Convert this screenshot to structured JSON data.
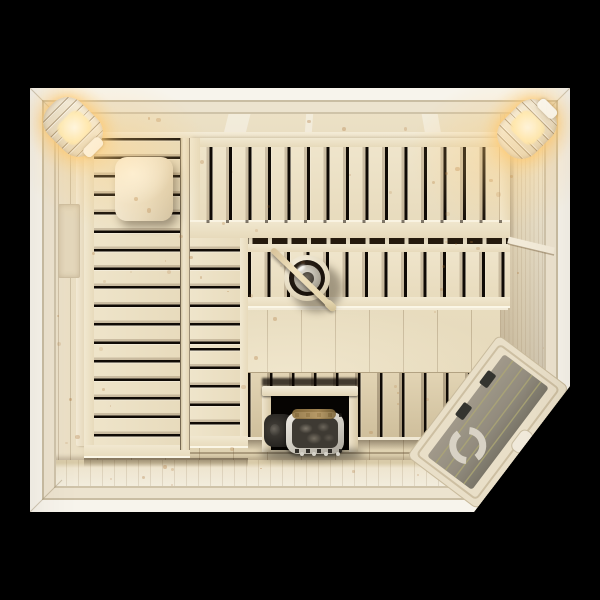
{
  "scene": {
    "description": "Top-down 3D render of a wooden sauna interior on a black background",
    "view": "top-down",
    "contains_text": false,
    "visible_text": ""
  },
  "objects": {
    "upper_bench": "upper tier bench with vertical slats along the top wall",
    "middle_bench": "lower tier bench with vertical slats",
    "left_bench": "full-length lounging bench with horizontal slats along the left wall",
    "bench_step": "lower step extension of the left bench",
    "headrest": "curved wooden headrest on the left bench",
    "bucket": "sauna bucket with ladle resting across it",
    "heater": "electric sauna heater filled with stones inside a wooden safety guard",
    "glass_door": "tinted glass door in the chamfered bottom-right corner with round logo, two hinges and handle",
    "lamp_left": "glowing wooden corner lamp, top-left",
    "lamp_right": "glowing wooden corner lamp, top-right",
    "backrest_rails": "backrest rails mounted on the walls",
    "floor": "wooden floor boards"
  },
  "colors": {
    "bg": "#000000",
    "trim-light": "#f8f5ee",
    "trim-cream": "#ece3cf",
    "groove": "#cbbfa6",
    "wood-mid": "#e9ddc1",
    "slot": "#0f0a05",
    "glass": "#867f6f",
    "glass-gap": "#a7a169",
    "logo": "#d8d2c5",
    "glow": "#ffd993",
    "stone": "#3e3a33",
    "steel": "#d9d5cc"
  }
}
